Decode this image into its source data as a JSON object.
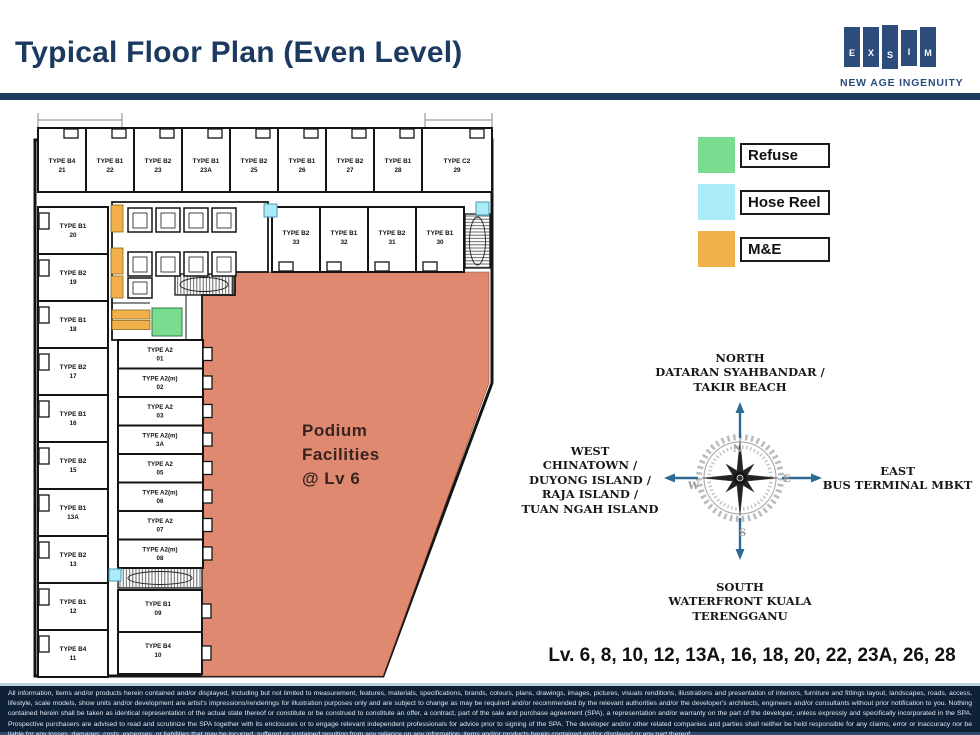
{
  "header": {
    "title": "Typical Floor Plan (Even Level)",
    "logo_letters": [
      "E",
      "X",
      "S",
      "I",
      "M"
    ],
    "tagline": "NEW AGE INGENUITY"
  },
  "legend": {
    "items": [
      {
        "label": "Refuse",
        "color": "#7adc8e"
      },
      {
        "label": "Hose Reel",
        "color": "#a9ebf6"
      },
      {
        "label": "M&E",
        "color": "#f1b04a"
      }
    ]
  },
  "compass": {
    "letters": {
      "n": "N",
      "e": "E",
      "s": "S",
      "w": "W"
    },
    "north": {
      "title": "NORTH",
      "lines": [
        "DATARAN SYAHBANDAR /",
        "TAKIR BEACH"
      ]
    },
    "west": {
      "title": "WEST",
      "lines": [
        "CHINATOWN /",
        "DUYONG ISLAND /",
        "RAJA ISLAND /",
        "TUAN NGAH ISLAND"
      ]
    },
    "east": {
      "title": "EAST",
      "lines": [
        "BUS TERMINAL MBKT"
      ]
    },
    "south": {
      "title": "SOUTH",
      "lines": [
        "WATERFRONT KUALA",
        "TERENGGANU"
      ]
    }
  },
  "levels_text": "Lv. 6, 8, 10, 12, 13A, 16, 18, 20, 22, 23A, 26, 28",
  "plan": {
    "podium_label_lines": [
      "Podium",
      "Facilities",
      "@ Lv 6"
    ],
    "colors": {
      "podium": "#df8a70",
      "refuse": "#7adc8e",
      "hose_reel": "#a9ebf6",
      "me": "#f1b04a"
    },
    "top_row": [
      {
        "type": "TYPE B4",
        "no": "21"
      },
      {
        "type": "TYPE B1",
        "no": "22"
      },
      {
        "type": "TYPE B2",
        "no": "23"
      },
      {
        "type": "TYPE B1",
        "no": "23A"
      },
      {
        "type": "TYPE B2",
        "no": "25"
      },
      {
        "type": "TYPE B1",
        "no": "26"
      },
      {
        "type": "TYPE B2",
        "no": "27"
      },
      {
        "type": "TYPE B1",
        "no": "28"
      },
      {
        "type": "TYPE C2",
        "no": "29"
      }
    ],
    "inner_row": [
      {
        "type": "TYPE B2",
        "no": "33"
      },
      {
        "type": "TYPE B1",
        "no": "32"
      },
      {
        "type": "TYPE B2",
        "no": "31"
      },
      {
        "type": "TYPE B1",
        "no": "30"
      }
    ],
    "left_col": [
      {
        "type": "TYPE B1",
        "no": "20"
      },
      {
        "type": "TYPE B2",
        "no": "19"
      },
      {
        "type": "TYPE B1",
        "no": "18"
      },
      {
        "type": "TYPE B2",
        "no": "17"
      },
      {
        "type": "TYPE B1",
        "no": "16"
      },
      {
        "type": "TYPE B2",
        "no": "15"
      },
      {
        "type": "TYPE B1",
        "no": "13A"
      },
      {
        "type": "TYPE B2",
        "no": "13"
      },
      {
        "type": "TYPE B1",
        "no": "12"
      },
      {
        "type": "TYPE B4",
        "no": "11"
      }
    ],
    "mid_col": [
      {
        "type": "TYPE A2",
        "no": "01"
      },
      {
        "type": "TYPE A2(m)",
        "no": "02"
      },
      {
        "type": "TYPE A2",
        "no": "03"
      },
      {
        "type": "TYPE A2(m)",
        "no": "3A"
      },
      {
        "type": "TYPE A2",
        "no": "05"
      },
      {
        "type": "TYPE A2(m)",
        "no": "06"
      },
      {
        "type": "TYPE A2",
        "no": "07"
      },
      {
        "type": "TYPE A2(m)",
        "no": "08"
      }
    ],
    "below_mid": [
      {
        "type": "TYPE B1",
        "no": "09"
      },
      {
        "type": "TYPE B4",
        "no": "10"
      }
    ]
  },
  "disclaimer": "All information, items and/or products herein contained and/or displayed, including but not limited to measurement, features, materials, specifications, brands, colours, plans, drawings, images, pictures, visuals renditions, illustrations and presentation of interiors, furniture and fittings layout, landscapes, roads, access, lifestyle, scale models, show units and/or development are artist's impressions/renderings for illustration purposes only and are subject to change as may be required and/or recommended by the relevant authorities and/or the developer's architects, engineers and/or consultants without prior notification to you. Nothing contained herein shall be taken as identical representation of the actual state thereof or constitute or be construed to constitute an offer, a contract, part of the sale and purchase agreement (SPA), a representation and/or warranty on the part of the developer, unless expressly and specifically incorporated in the SPA. Prospective purchasers are advised to read and scrutinize the SPA together with its enclosures or to engage relevant independent professionals for advice prior to signing of the SPA. The developer and/or other related companies and parties shall neither be held responsible for any claims, error or inaccuracy nor be liable for any losses, damages, costs, expenses, or liabilities that may be incurred, suffered or sustained resulting from any reliance on any information, items and/or products herein contained and/or displayed or any part thereof."
}
